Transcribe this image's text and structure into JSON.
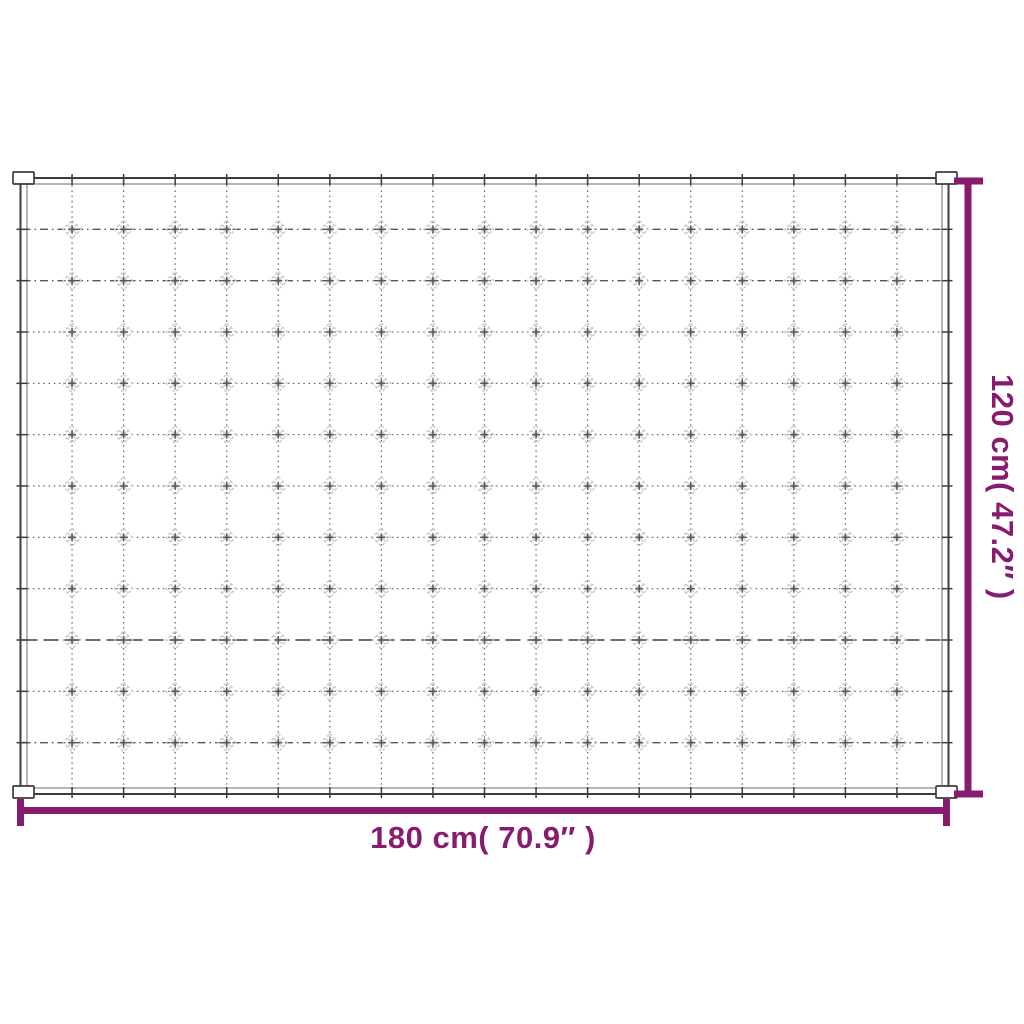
{
  "colors": {
    "background": "#ffffff",
    "accent": "#871c6f",
    "ink": "#3c3c3c",
    "inner_edge": "#7a7a7a",
    "grid_line": "#6f6f6f",
    "stitch": "#c9c9c9"
  },
  "diagram": {
    "illustration": "quilted-blanket-top-view-sketch",
    "grid": {
      "columns": 18,
      "rows": 12
    },
    "labels": {
      "width": "180 cm( 70.9″ )",
      "height": "120 cm( 47.2″ )"
    },
    "dimensions": {
      "width_cm": 180,
      "width_inches": 70.9,
      "height_cm": 120,
      "height_inches": 47.2
    }
  }
}
